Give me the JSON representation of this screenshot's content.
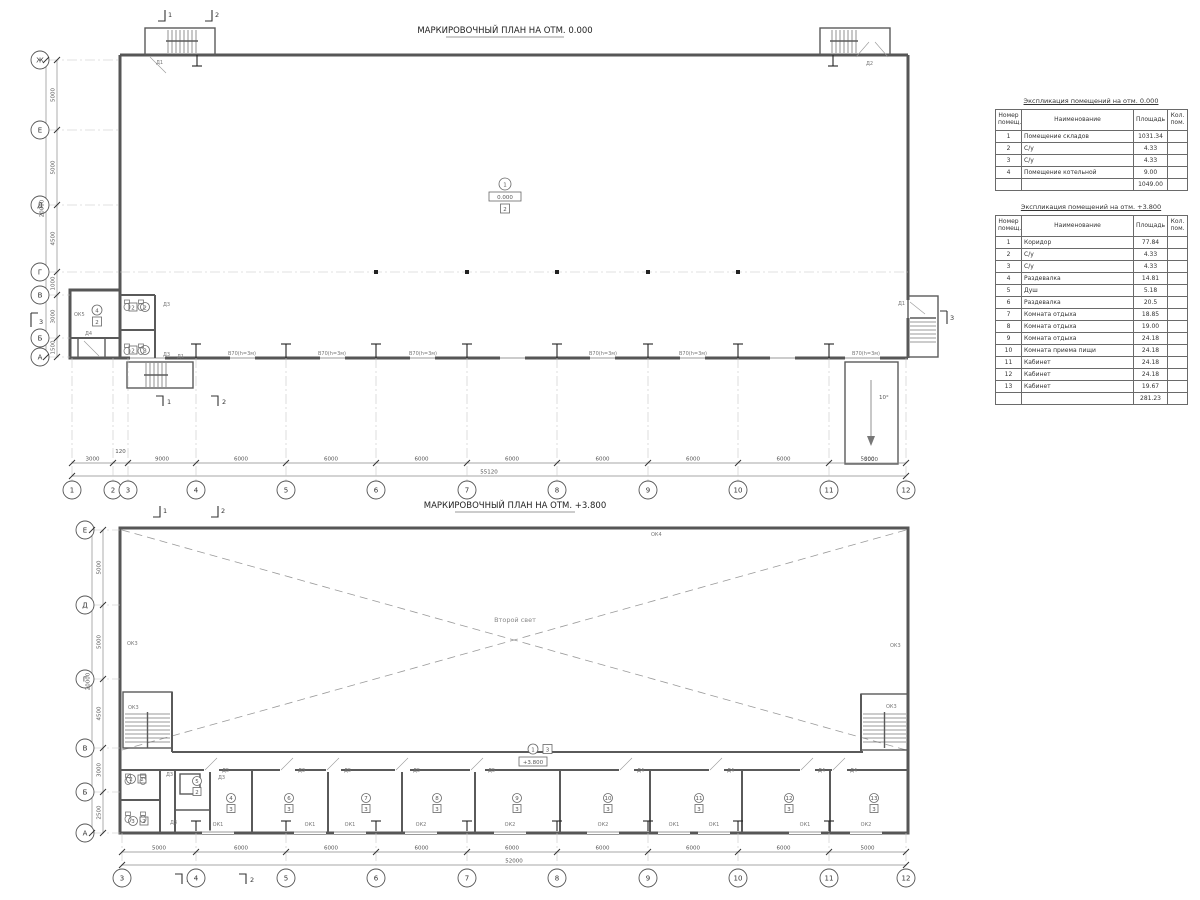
{
  "drawing": {
    "plan1": {
      "title": "МАРКИРОВОЧНЫЙ ПЛАН НА ОТМ. 0.000",
      "axes_bottom": [
        "1",
        "2",
        "3",
        "4",
        "5",
        "6",
        "7",
        "8",
        "9",
        "10",
        "11",
        "12"
      ],
      "dims_bottom": [
        "3000",
        "120",
        "9000",
        "6000",
        "6000",
        "6000",
        "6000",
        "6000",
        "6000",
        "6000",
        "5000"
      ],
      "dim_total_bottom": "55120",
      "axes_left": [
        "Ж",
        "Е",
        "Д",
        "Г",
        "В",
        "Б",
        "А"
      ],
      "dims_left": [
        "5000",
        "5000",
        "4500",
        "1000",
        "3000",
        "1500"
      ],
      "dim_total_left": "20000",
      "stair_door_left": "Д1",
      "stair_door_right": "Д2",
      "door_right": "Д1",
      "door_stair_bottom": "Д1",
      "toilet_door_1": "Д3",
      "toilet_door_2": "Д3",
      "annex_door": "Д4",
      "annex_window": "ОК5",
      "wall_panel_labels": [
        "В70(h=3м)",
        "В70(h=3м)",
        "В70(h=3м)",
        "В70(h=3м)",
        "В70(h=3м)",
        "В70(h=3м)"
      ],
      "room_marker": {
        "number": "1",
        "elevation": "0.000",
        "type": "2"
      },
      "annex_marker": {
        "number": "4",
        "type": "2"
      },
      "toilet_marker_1": {
        "number": "2",
        "type": "2"
      },
      "toilet_marker_2": {
        "number": "3",
        "type": "2"
      },
      "ramp": {
        "angle": "10°",
        "dim": "5000"
      },
      "sections": {
        "top": [
          "1",
          "2"
        ],
        "bottom": [
          "1",
          "2"
        ],
        "left": "3",
        "right": "3"
      }
    },
    "plan2": {
      "title": "МАРКИРОВОЧНЫЙ ПЛАН НА ОТМ. +3.800",
      "axes_bottom": [
        "3",
        "4",
        "5",
        "6",
        "7",
        "8",
        "9",
        "10",
        "11",
        "12"
      ],
      "dims_bottom": [
        "5000",
        "6000",
        "6000",
        "6000",
        "6000",
        "6000",
        "6000",
        "6000",
        "5000"
      ],
      "dim_total_bottom": "52000",
      "axes_left": [
        "Е",
        "Д",
        "Г",
        "В",
        "Б",
        "А"
      ],
      "dims_left": [
        "5000",
        "5000",
        "4500",
        "3000",
        "2500"
      ],
      "dim_total_left": "20000",
      "void_label": "Второй свет",
      "corridor_marker": {
        "number": "1",
        "type": "3",
        "elevation": "+3.800"
      },
      "window_top": "ОК4",
      "window_left_wall": "ОК3",
      "window_left_stair": "ОК3",
      "window_right_stair": "ОК3",
      "window_right_wall": "ОК3",
      "window_labels": [
        "ОК1",
        "ОК1",
        "ОК1",
        "ОК2",
        "ОК2",
        "ОК2",
        "ОК1",
        "ОК1",
        "ОК1",
        "ОК2"
      ],
      "door_labels_left": [
        "Д5",
        "Д3",
        "Д5",
        "Д5",
        "Д5"
      ],
      "door_labels_right": [
        "Д4",
        "Д4",
        "Д4",
        "Д4"
      ],
      "toilet_doors": [
        "Д3",
        "Д3",
        "Д3"
      ],
      "room_markers": [
        {
          "number": "2",
          "type": "2"
        },
        {
          "number": "3",
          "type": "2"
        },
        {
          "number": "5",
          "type": "2"
        },
        {
          "number": "4",
          "type": "3"
        },
        {
          "number": "6",
          "type": "3"
        },
        {
          "number": "7",
          "type": "3"
        },
        {
          "number": "8",
          "type": "3"
        },
        {
          "number": "9",
          "type": "3"
        },
        {
          "number": "10",
          "type": "3"
        },
        {
          "number": "11",
          "type": "3"
        },
        {
          "number": "12",
          "type": "3"
        },
        {
          "number": "13",
          "type": "3"
        }
      ],
      "sections": {
        "top": [
          "1",
          "2"
        ],
        "bottom": [
          "1",
          "2"
        ]
      }
    }
  },
  "tables": [
    {
      "title": "Экспликация помещений на отм. 0.000",
      "headers": [
        "Номер помещ.",
        "Наименование",
        "Площадь",
        "Кол. пом."
      ],
      "rows": [
        [
          "1",
          "Помещение складов",
          "1031.34",
          ""
        ],
        [
          "2",
          "С/у",
          "4.33",
          ""
        ],
        [
          "3",
          "С/у",
          "4.33",
          ""
        ],
        [
          "4",
          "Помещение котельной",
          "9.00",
          ""
        ]
      ],
      "total": "1049.00"
    },
    {
      "title": "Экспликация помещений на отм. +3.800",
      "headers": [
        "Номер помещ.",
        "Наименование",
        "Площадь",
        "Кол. пом."
      ],
      "rows": [
        [
          "1",
          "Коридор",
          "77.84",
          ""
        ],
        [
          "2",
          "С/у",
          "4.33",
          ""
        ],
        [
          "3",
          "С/у",
          "4.33",
          ""
        ],
        [
          "4",
          "Раздевалка",
          "14.81",
          ""
        ],
        [
          "5",
          "Душ",
          "5.18",
          ""
        ],
        [
          "6",
          "Раздевалка",
          "20.5",
          ""
        ],
        [
          "7",
          "Комната отдыха",
          "18.85",
          ""
        ],
        [
          "8",
          "Комната отдыха",
          "19.00",
          ""
        ],
        [
          "9",
          "Комната отдыха",
          "24.18",
          ""
        ],
        [
          "10",
          "Комната приема пищи",
          "24.18",
          ""
        ],
        [
          "11",
          "Кабинет",
          "24.18",
          ""
        ],
        [
          "12",
          "Кабинет",
          "24.18",
          ""
        ],
        [
          "13",
          "Кабинет",
          "19.67",
          ""
        ]
      ],
      "total": "281.23"
    }
  ]
}
